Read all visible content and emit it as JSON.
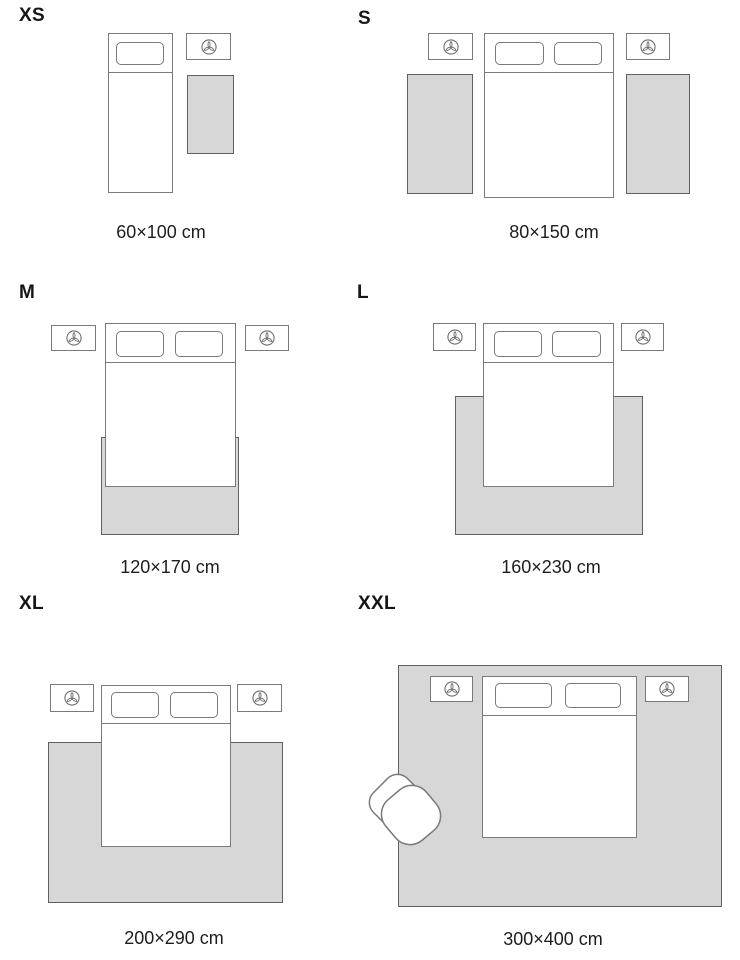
{
  "guide": {
    "colors": {
      "line": "#7a7a7a",
      "rug_fill": "#d7d7d7",
      "rug_border": "#616161",
      "text": "#1d1d1d"
    },
    "icons": {
      "nightstand_decor": "plant-top-view",
      "xxl_extra": "armchair-top-view"
    },
    "panels": [
      {
        "id": "xs",
        "label": "XS",
        "dimensions": "60×100 cm"
      },
      {
        "id": "s",
        "label": "S",
        "dimensions": "80×150 cm"
      },
      {
        "id": "m",
        "label": "M",
        "dimensions": "120×170 cm"
      },
      {
        "id": "l",
        "label": "L",
        "dimensions": "160×230 cm"
      },
      {
        "id": "xl",
        "label": "XL",
        "dimensions": "200×290 cm"
      },
      {
        "id": "xxl",
        "label": "XXL",
        "dimensions": "300×400 cm"
      }
    ]
  }
}
